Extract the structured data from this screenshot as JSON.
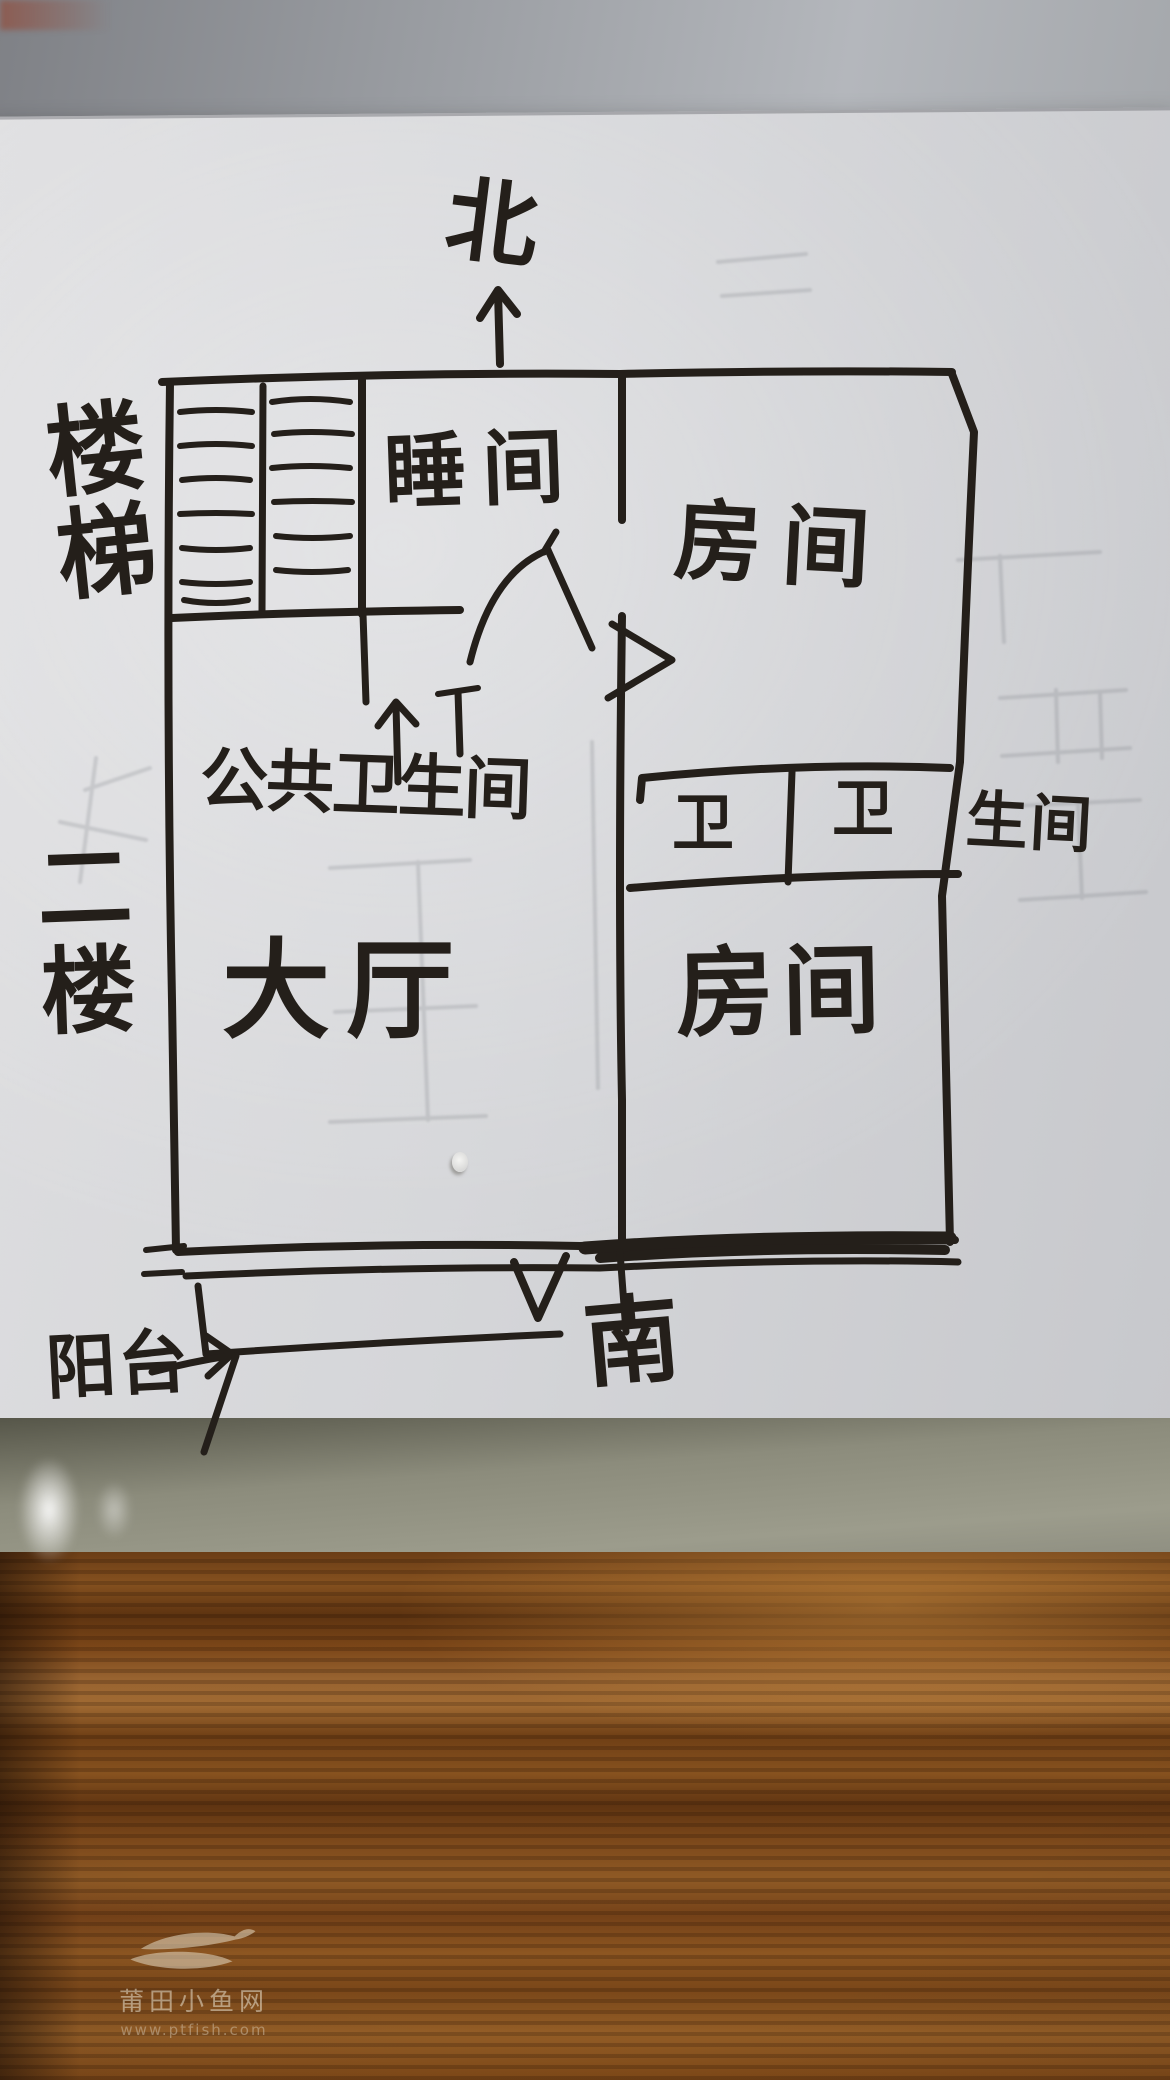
{
  "plan": {
    "ink_color": "#241f1a",
    "compass_north": "北",
    "compass_south": "南",
    "stairs_label": "楼梯",
    "floor_label": "二楼",
    "room_sleep": "睡间",
    "room_upper_right": "房间",
    "room_lower_right": "房间",
    "hall": "大厅",
    "shared_bathroom": "公共卫生间",
    "wc_cell_left": "卫",
    "wc_cell_right": "卫",
    "wc_suffix_outside": "生间",
    "balcony": "阳台"
  },
  "watermark": {
    "site": "莆田小鱼网",
    "url": "www.ptfish.com"
  }
}
